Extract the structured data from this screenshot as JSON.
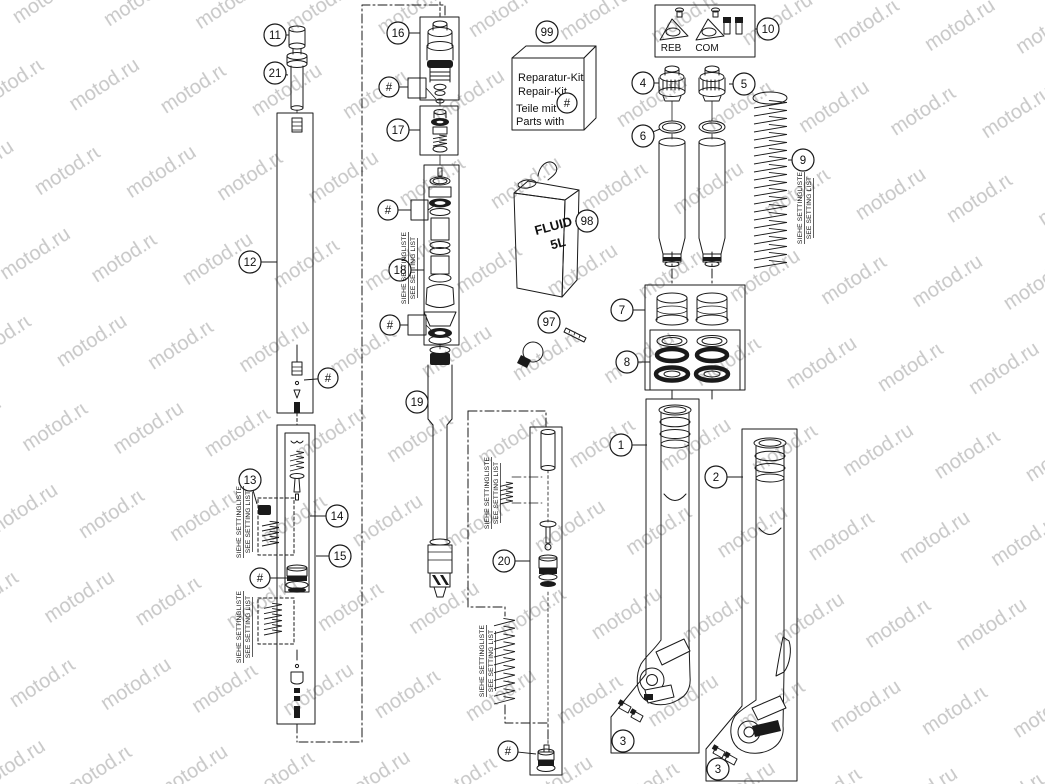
{
  "diagram": {
    "watermark": "motod.ru",
    "watermark_color": "#c8c8c8",
    "line_color": "#1a1a1a",
    "setting_note": {
      "de": "SIEHE SETTINGLISTE",
      "en": "SEE SETTING LIST"
    },
    "repair_kit": {
      "callout": "99",
      "line1": "Reparatur-Kit",
      "line2": "Repair-Kit",
      "line3": "Teile mit",
      "line4": "Parts with",
      "hash_symbol": "#"
    },
    "fluid_can": {
      "callout": "98",
      "line1": "FLUID",
      "line2": "5L"
    },
    "adjuster_kit": {
      "callout": "10",
      "left_label": "REB",
      "right_label": "COM"
    },
    "callouts": [
      {
        "id": "1",
        "label": "1"
      },
      {
        "id": "2",
        "label": "2"
      },
      {
        "id": "3-left",
        "label": "3"
      },
      {
        "id": "3-right",
        "label": "3"
      },
      {
        "id": "4",
        "label": "4"
      },
      {
        "id": "5",
        "label": "5"
      },
      {
        "id": "6",
        "label": "6"
      },
      {
        "id": "7",
        "label": "7"
      },
      {
        "id": "8",
        "label": "8"
      },
      {
        "id": "9",
        "label": "9"
      },
      {
        "id": "10",
        "label": "10"
      },
      {
        "id": "11",
        "label": "11"
      },
      {
        "id": "12",
        "label": "12"
      },
      {
        "id": "13",
        "label": "13"
      },
      {
        "id": "14",
        "label": "14"
      },
      {
        "id": "15",
        "label": "15"
      },
      {
        "id": "16",
        "label": "16"
      },
      {
        "id": "17",
        "label": "17"
      },
      {
        "id": "18",
        "label": "18"
      },
      {
        "id": "19",
        "label": "19"
      },
      {
        "id": "20",
        "label": "20"
      },
      {
        "id": "21",
        "label": "21"
      },
      {
        "id": "97",
        "label": "97"
      },
      {
        "id": "98",
        "label": "98"
      },
      {
        "id": "99",
        "label": "99"
      },
      {
        "id": "hash-12",
        "label": "#"
      },
      {
        "id": "hash-15",
        "label": "#"
      },
      {
        "id": "hash-16",
        "label": "#"
      },
      {
        "id": "hash-18a",
        "label": "#"
      },
      {
        "id": "hash-18b",
        "label": "#"
      },
      {
        "id": "hash-20",
        "label": "#"
      },
      {
        "id": "hash-kit",
        "label": "#"
      }
    ]
  }
}
